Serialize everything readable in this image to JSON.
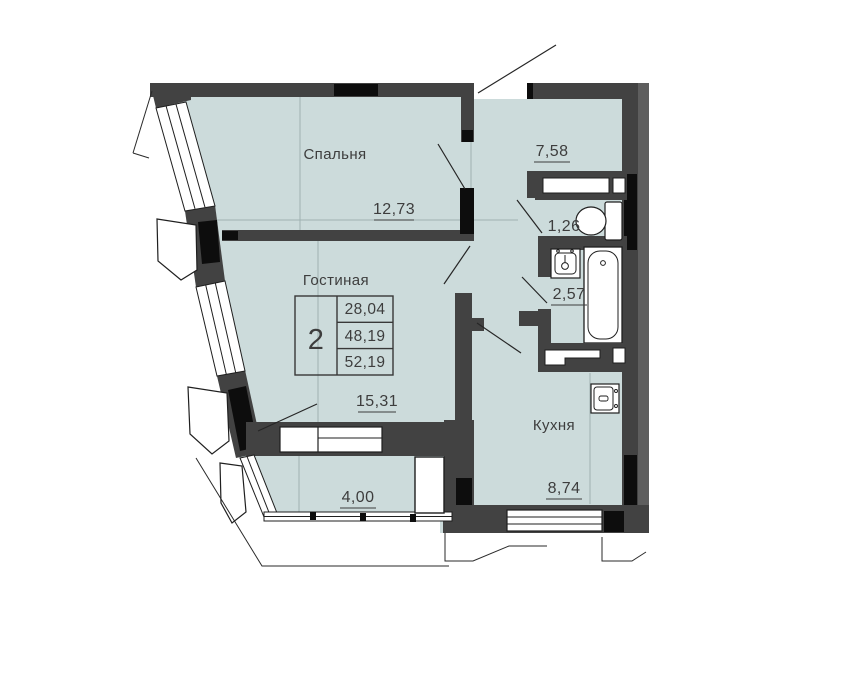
{
  "rooms": {
    "bedroom": {
      "label": "Спальня",
      "area": "12,73"
    },
    "living_room": {
      "label": "Гостиная",
      "area": "15,31"
    },
    "kitchen": {
      "label": "Кухня",
      "area": "8,74"
    },
    "hallway": {
      "area": "7,58"
    },
    "toilet": {
      "area": "1,26"
    },
    "bathroom": {
      "area": "2,57"
    },
    "balcony": {
      "area": "4,00"
    }
  },
  "info_table": {
    "rooms_count": "2",
    "living_area": "28,04",
    "floor_area": "48,19",
    "total_area": "52,19"
  },
  "colors": {
    "floor_fill": "#ccdbdb",
    "wall": "#424242",
    "wall_accent": "#0d0d0d",
    "outer_band": "#5e5e5e"
  }
}
